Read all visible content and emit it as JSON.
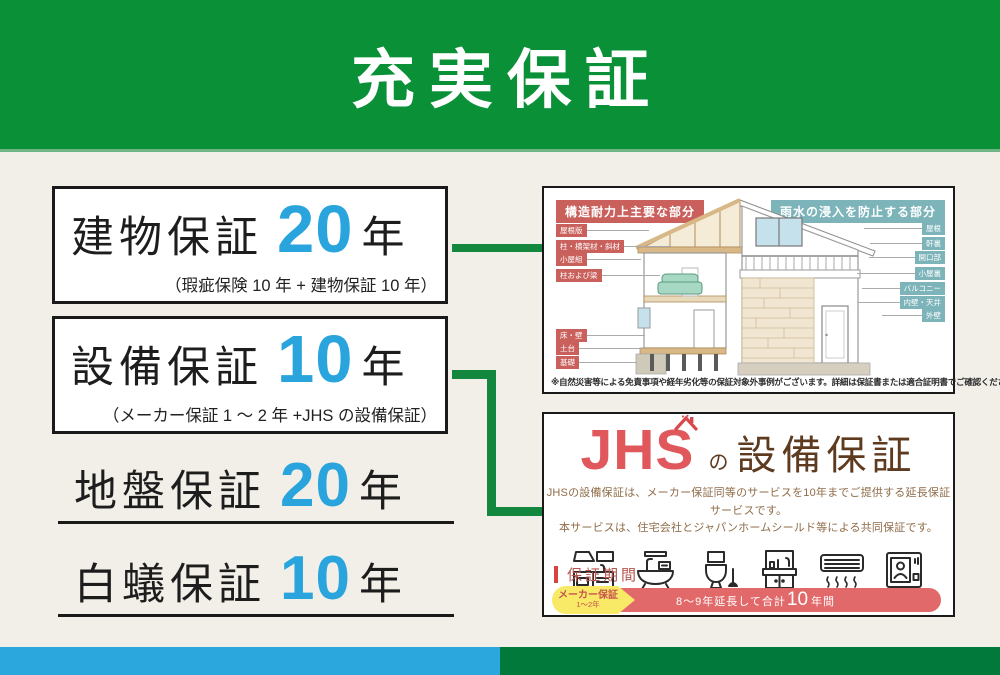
{
  "title_banner": {
    "title": "充実保証"
  },
  "warranty_list": [
    {
      "label": "建物保証",
      "years": "20",
      "unit": "年",
      "note": "（瑕疵保険 10 年 + 建物保証 10 年）"
    },
    {
      "label": "設備保証",
      "years": "10",
      "unit": "年",
      "note": "（メーカー保証 1 ～ 2 年 +JHS の設備保証）"
    },
    {
      "label": "地盤保証",
      "years": "20",
      "unit": "年"
    },
    {
      "label": "白蟻保証",
      "years": "10",
      "unit": "年"
    }
  ],
  "house_panel": {
    "left_header": "構造耐力上主要な部分",
    "right_header": "雨水の浸入を防止する部分",
    "left_labels": [
      "屋根版",
      "柱・横架材・斜材",
      "小屋組",
      "柱および梁",
      "床・壁",
      "土台",
      "基礎"
    ],
    "right_labels": [
      "屋根",
      "軒裏",
      "開口部",
      "小屋裏",
      "バルコニー",
      "内壁・天井",
      "外壁"
    ],
    "note": "※自然災害等による免責事項や経年劣化等の保証対象外事例がございます。詳細は保証書または適合証明書でご確認ください。"
  },
  "jhs_panel": {
    "logo_text": "JHS",
    "logo_particle": "の",
    "logo_title": "設備保証",
    "description_line1": "JHSの設備保証は、メーカー保証同等のサービスを10年までご提供する延長保証サービスです。",
    "description_line2": "本サービスは、住宅会社とジャパンホームシールド等による共同保証です。",
    "icon_names": [
      "kitchen-icon",
      "bathtub-icon",
      "toilet-icon",
      "washbasin-icon",
      "air-conditioner-icon",
      "intercom-icon"
    ],
    "period_heading": "保証期間",
    "timeline": {
      "maker_label": "メーカー保証",
      "maker_years": "1～2年",
      "extension_prefix": "8～9年延長して合計",
      "extension_total": "10",
      "extension_suffix": "年間"
    }
  },
  "colors": {
    "banner_green": "#0A9138",
    "footer_green": "#00793B",
    "footer_blue": "#2BA7DE",
    "number_blue": "#29A4DC",
    "structure_label_red": "#C9605C",
    "rain_label_teal": "#7CB4BA",
    "jhs_red": "#E0585C",
    "jhs_brown": "#5E3A1E",
    "timeline_red": "#E2696A",
    "timeline_yellow": "#F8E967"
  }
}
